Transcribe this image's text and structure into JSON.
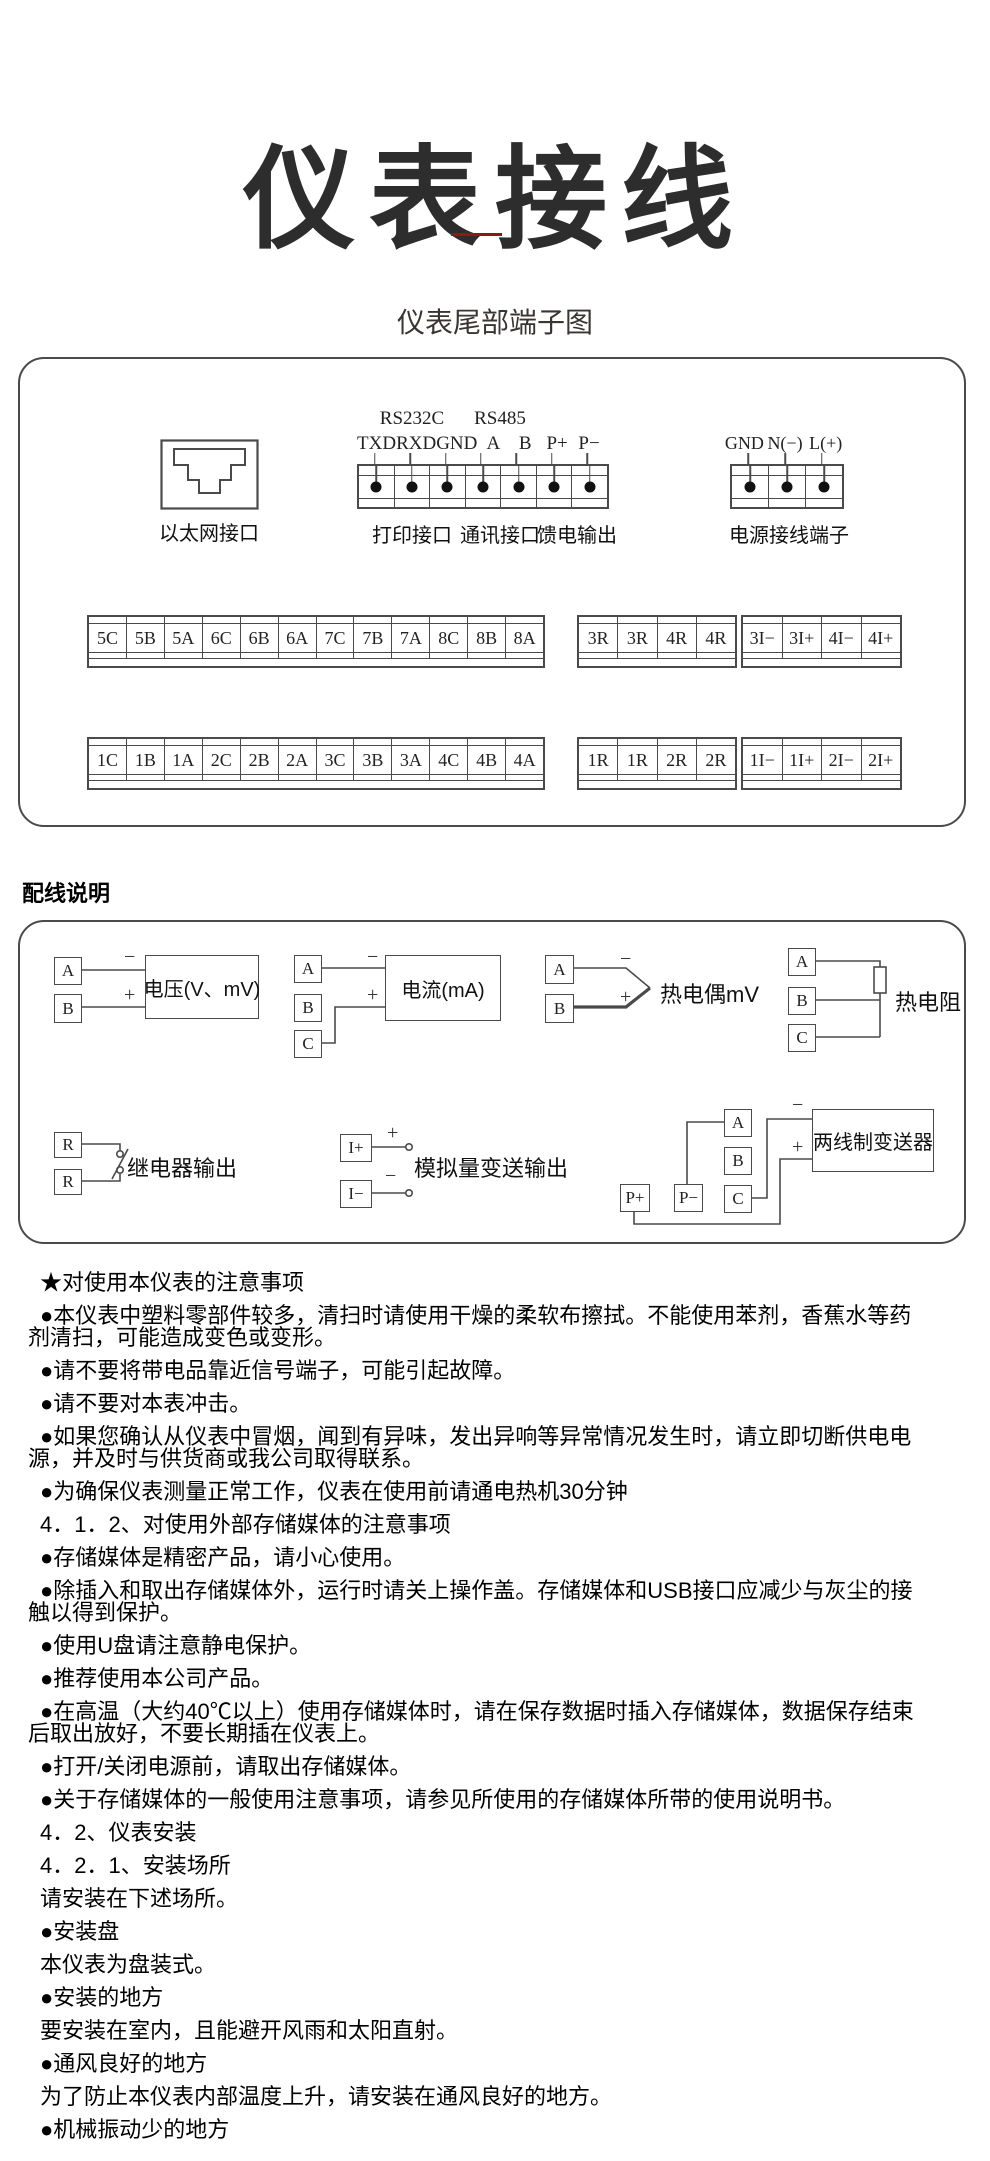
{
  "page": {
    "title": "仪表接线",
    "subtitle": "仪表尾部端子图",
    "wiring_section_title": "配线说明"
  },
  "colors": {
    "divider_accent": "#8a1a1a",
    "line": "#4a4a4a"
  },
  "terminal_box": {
    "ethernet": {
      "label": "以太网接口"
    },
    "serial": {
      "group_labels": [
        "RS232C",
        "RS485"
      ],
      "pins": [
        "TXD",
        "RXD",
        "GND",
        "A",
        "B",
        "P+",
        "P−"
      ],
      "captions": [
        "打印接口",
        "通讯接口",
        "馈电输出"
      ]
    },
    "power": {
      "pins": [
        "GND",
        "N(−)",
        "L(+)"
      ],
      "caption": "电源接线端子"
    },
    "strips": {
      "row1": [
        [
          "5C",
          "5B",
          "5A",
          "6C",
          "6B",
          "6A",
          "7C",
          "7B",
          "7A",
          "8C",
          "8B",
          "8A"
        ],
        [
          "3R",
          "3R",
          "4R",
          "4R"
        ],
        [
          "3I−",
          "3I+",
          "4I−",
          "4I+"
        ]
      ],
      "row2": [
        [
          "1C",
          "1B",
          "1A",
          "2C",
          "2B",
          "2A",
          "3C",
          "3B",
          "3A",
          "4C",
          "4B",
          "4A"
        ],
        [
          "1R",
          "1R",
          "2R",
          "2R"
        ],
        [
          "1I−",
          "1I+",
          "2I−",
          "2I+"
        ]
      ]
    }
  },
  "wiring_box": {
    "polarity": {
      "plus": "+",
      "minus": "−"
    },
    "voltage": {
      "terminals": [
        "A",
        "B"
      ],
      "label": "电压(V、mV)"
    },
    "current": {
      "terminals": [
        "A",
        "B",
        "C"
      ],
      "label": "电流(mA)"
    },
    "thermocouple": {
      "terminals": [
        "A",
        "B"
      ],
      "label": "热电偶mV"
    },
    "rtd": {
      "terminals": [
        "A",
        "B",
        "C"
      ],
      "label": "热电阻"
    },
    "relay": {
      "terminals": [
        "R",
        "R"
      ],
      "label": "继电器输出"
    },
    "analog_out": {
      "terminals": [
        "I+",
        "I−"
      ],
      "label": "模拟量变送输出"
    },
    "transmitter": {
      "terminals_bottom": [
        "P+",
        "P−"
      ],
      "terminals_right": [
        "A",
        "B",
        "C"
      ],
      "label": "两线制变送器"
    }
  },
  "notes": {
    "paragraphs": [
      "★对使用本仪表的注意事项",
      "●本仪表中塑料零部件较多，清扫时请使用干燥的柔软布擦拭。不能使用苯剂，香蕉水等药剂清扫，可能造成变色或变形。",
      "●请不要将带电品靠近信号端子，可能引起故障。",
      "●请不要对本表冲击。",
      "●如果您确认从仪表中冒烟，闻到有异味，发出异响等异常情况发生时，请立即切断供电电源，并及时与供货商或我公司取得联系。",
      "●为确保仪表测量正常工作，仪表在使用前请通电热机30分钟",
      "4．1．2、对使用外部存储媒体的注意事项",
      "●存储媒体是精密产品，请小心使用。",
      "●除插入和取出存储媒体外，运行时请关上操作盖。存储媒体和USB接口应减少与灰尘的接触以得到保护。",
      "●使用U盘请注意静电保护。",
      "●推荐使用本公司产品。",
      "●在高温（大约40℃以上）使用存储媒体时，请在保存数据时插入存储媒体，数据保存结束后取出放好，不要长期插在仪表上。",
      "●打开/关闭电源前，请取出存储媒体。",
      "●关于存储媒体的一般使用注意事项，请参见所使用的存储媒体所带的使用说明书。",
      "4．2、仪表安装",
      "4．2．1、安装场所",
      "请安装在下述场所。",
      "●安装盘",
      "本仪表为盘装式。",
      "●安装的地方",
      "要安装在室内，且能避开风雨和太阳直射。",
      "●通风良好的地方",
      "为了防止本仪表内部温度上升，请安装在通风良好的地方。",
      "●机械振动少的地方"
    ]
  }
}
